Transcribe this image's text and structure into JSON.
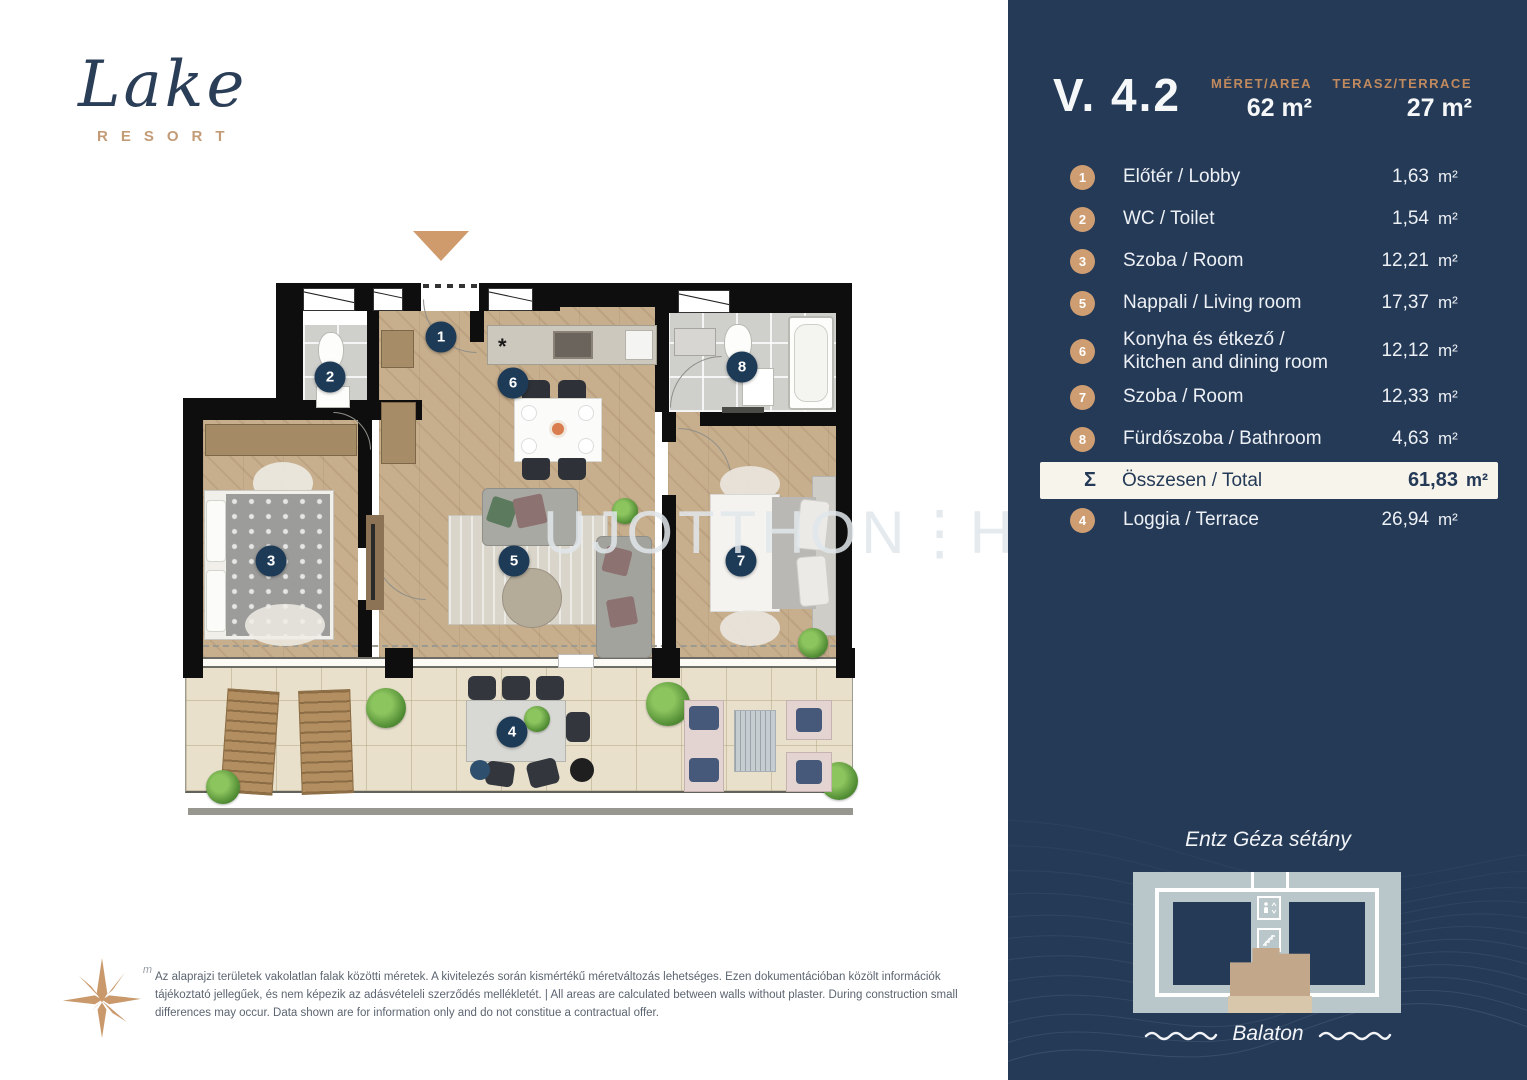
{
  "logo": {
    "name": "Lake",
    "tagline": "RESORT"
  },
  "watermark": {
    "part1": "UJOTTHON",
    "sep": "⋮",
    "part2": "HU"
  },
  "plan": {
    "kitchen_star": "*",
    "badges": [
      {
        "n": "1"
      },
      {
        "n": "2"
      },
      {
        "n": "6"
      },
      {
        "n": "8"
      },
      {
        "n": "3"
      },
      {
        "n": "5"
      },
      {
        "n": "7"
      },
      {
        "n": "4"
      }
    ]
  },
  "compass": {
    "label": "m"
  },
  "disclaimer": {
    "text": "Az alaprajzi területek vakolatlan falak közötti méretek. A kivitelezés során kismértékű méretváltozás lehetséges. Ezen dokumentációban közölt információk tájékoztató jellegűek, és nem képezik az adásvételeli szerződés mellékletét. | All areas are calculated between walls without plaster. During construction small differences may occur. Data shown are for information only and do not constitue a contractual offer."
  },
  "sidebar": {
    "unit_id": "V. 4.2",
    "size_label": "MÉRET/AREA",
    "size_value": "62 m²",
    "terrace_label": "TERASZ/TERRACE",
    "terrace_value": "27 m²",
    "rooms": [
      {
        "num": "1",
        "label": "Előtér / Lobby",
        "area": "1,63",
        "unit": "m²"
      },
      {
        "num": "2",
        "label": "WC / Toilet",
        "area": "1,54",
        "unit": "m²"
      },
      {
        "num": "3",
        "label": "Szoba / Room",
        "area": "12,21",
        "unit": "m²"
      },
      {
        "num": "5",
        "label": "Nappali / Living room",
        "area": "17,37",
        "unit": "m²"
      },
      {
        "num": "6",
        "label": "Konyha és étkező / Kitchen and dining room",
        "area": "12,12",
        "unit": "m²"
      },
      {
        "num": "7",
        "label": "Szoba / Room",
        "area": "12,33",
        "unit": "m²"
      },
      {
        "num": "8",
        "label": "Fürdőszoba / Bathroom",
        "area": "4,63",
        "unit": "m²"
      }
    ],
    "total": {
      "symbol": "Σ",
      "label": "Összesen / Total",
      "area": "61,83",
      "unit": "m²"
    },
    "loggia": {
      "num": "4",
      "label": "Loggia / Terrace",
      "area": "26,94",
      "unit": "m²"
    },
    "minimap": {
      "street": "Entz Géza sétány",
      "water": "Balaton"
    }
  }
}
